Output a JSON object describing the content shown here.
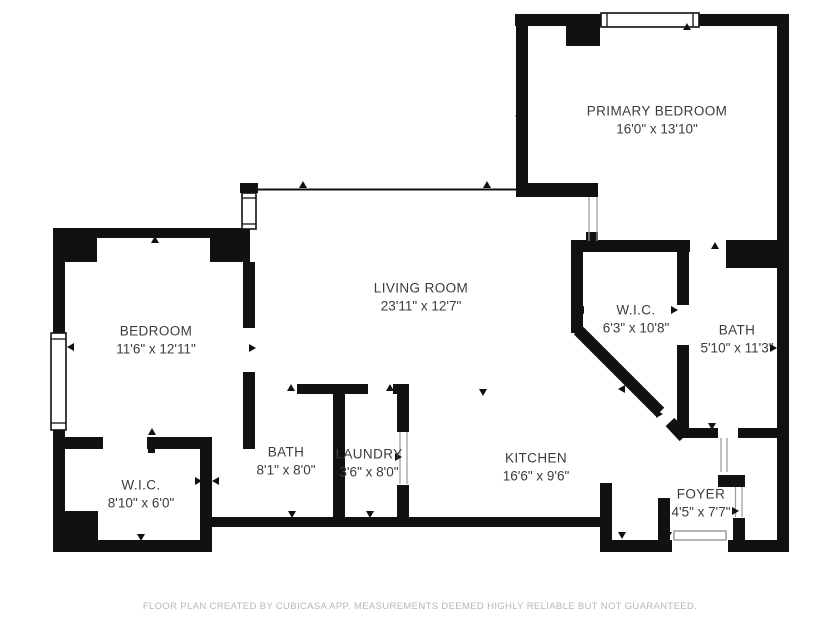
{
  "colors": {
    "wall": "#111111",
    "text": "#3c3c3c",
    "footer_text": "#b7b7b7"
  },
  "rooms": [
    {
      "id": "primary-bedroom",
      "name": "PRIMARY BEDROOM",
      "dimensions": "16'0\" x 13'10\""
    },
    {
      "id": "living-room",
      "name": "LIVING ROOM",
      "dimensions": "23'11\" x 12'7\""
    },
    {
      "id": "bedroom",
      "name": "BEDROOM",
      "dimensions": "11'6\" x 12'11\""
    },
    {
      "id": "wic-primary",
      "name": "W.I.C.",
      "dimensions": "6'3\" x 10'8\""
    },
    {
      "id": "bath-primary",
      "name": "BATH",
      "dimensions": "5'10\" x 11'3\""
    },
    {
      "id": "bath",
      "name": "BATH",
      "dimensions": "8'1\" x 8'0\""
    },
    {
      "id": "laundry",
      "name": "LAUNDRY",
      "dimensions": "3'6\" x 8'0\""
    },
    {
      "id": "kitchen",
      "name": "KITCHEN",
      "dimensions": "16'6\" x 9'6\""
    },
    {
      "id": "wic",
      "name": "W.I.C.",
      "dimensions": "8'10\" x 6'0\""
    },
    {
      "id": "foyer",
      "name": "FOYER",
      "dimensions": "4'5\" x 7'7\""
    }
  ],
  "footer": {
    "disclaimer": "FLOOR PLAN CREATED BY CUBICASA APP. MEASUREMENTS DEEMED HIGHLY RELIABLE BUT NOT GUARANTEED."
  }
}
